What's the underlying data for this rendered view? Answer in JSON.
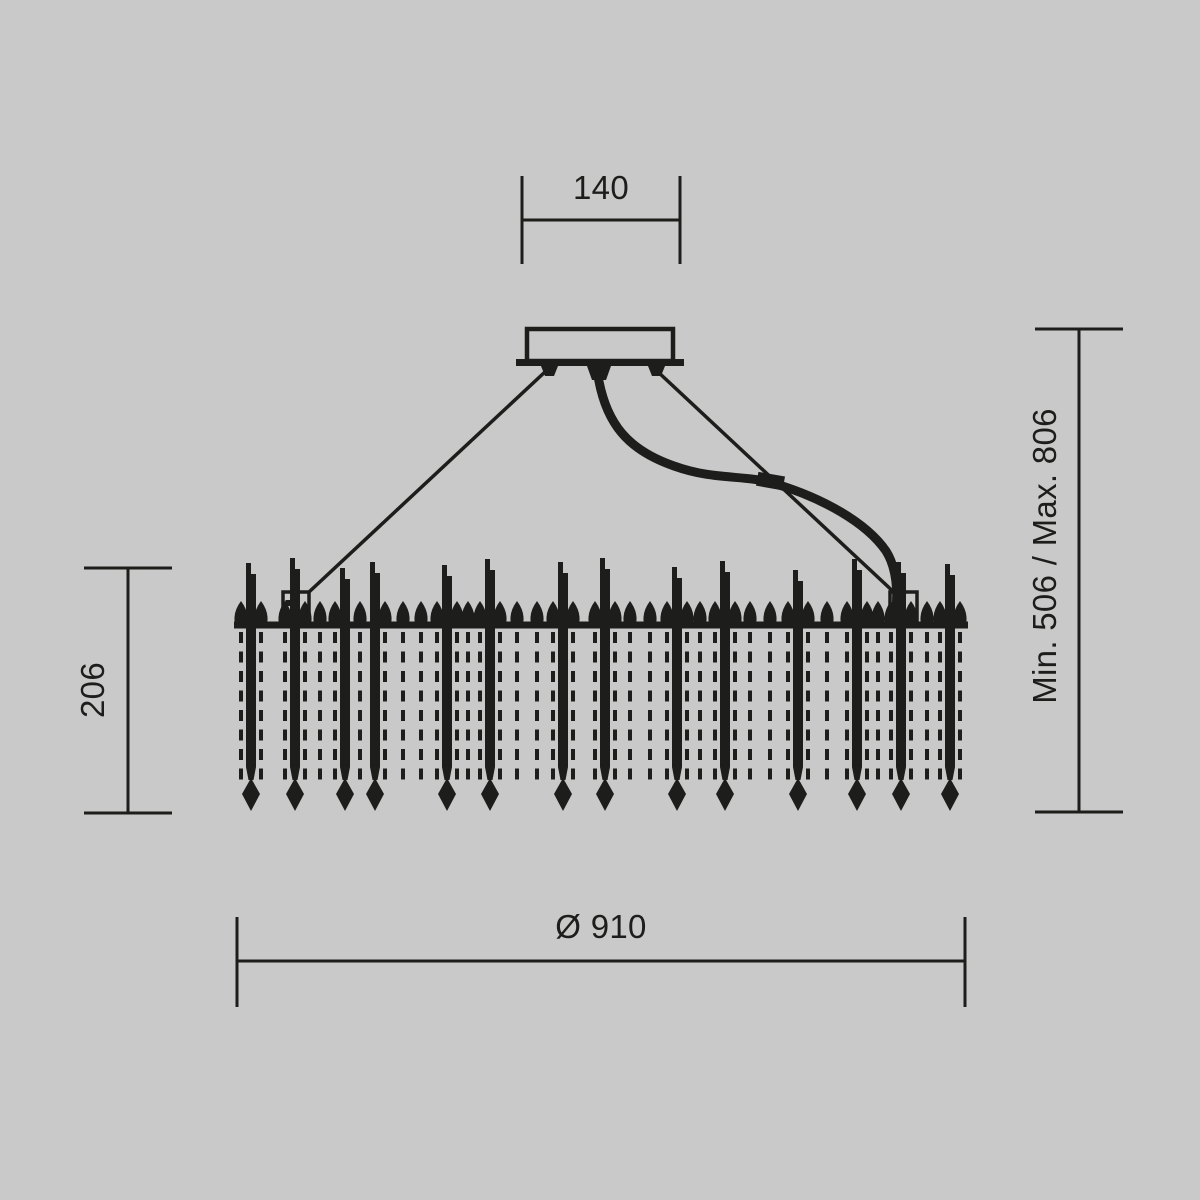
{
  "drawing": {
    "kind": "chandelier-technical-dimension-drawing"
  },
  "colors": {
    "background": "#c9c9c9",
    "ink": "#1d1d1b"
  },
  "dimensions": {
    "canopy_width": {
      "label": "140"
    },
    "body_height": {
      "label": "206"
    },
    "suspension": {
      "label": "Min. 506 / Max. 806"
    },
    "diameter": {
      "label": "Ø 910"
    }
  },
  "fixture": {
    "ring": {
      "x1": 234,
      "x2": 968,
      "y": 625,
      "thickness": 7
    },
    "rods": [
      {
        "x": 251,
        "top": 563
      },
      {
        "x": 295,
        "top": 558
      },
      {
        "x": 345,
        "top": 568
      },
      {
        "x": 375,
        "top": 562
      },
      {
        "x": 447,
        "top": 565
      },
      {
        "x": 490,
        "top": 559
      },
      {
        "x": 563,
        "top": 562
      },
      {
        "x": 605,
        "top": 558
      },
      {
        "x": 677,
        "top": 567
      },
      {
        "x": 725,
        "top": 561
      },
      {
        "x": 798,
        "top": 570
      },
      {
        "x": 857,
        "top": 559
      },
      {
        "x": 901,
        "top": 562
      },
      {
        "x": 950,
        "top": 564
      }
    ],
    "strands_x": [
      241,
      261,
      285,
      305,
      320,
      335,
      360,
      385,
      403,
      421,
      437,
      457,
      468,
      480,
      500,
      517,
      537,
      553,
      573,
      595,
      615,
      630,
      650,
      667,
      687,
      700,
      715,
      735,
      750,
      770,
      788,
      808,
      827,
      847,
      867,
      878,
      891,
      911,
      927,
      940,
      960
    ],
    "strand": {
      "y1": 632,
      "y2": 787,
      "width": 4,
      "dash": "11 8.5"
    },
    "rod_solid_bottom": 767,
    "drop_top": 778,
    "drop_mid": 794,
    "drop_bottom": 811,
    "drop_halfwidth": 9
  }
}
